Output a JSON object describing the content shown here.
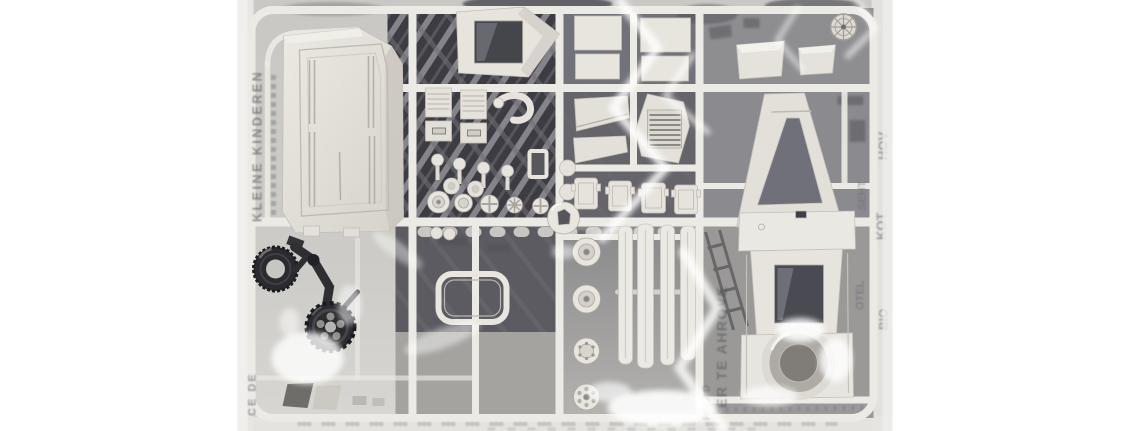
{
  "page": {
    "background_color": "#ffffff"
  },
  "photo": {
    "subject": "Plastic scale-model kit sprue sealed in a clear polybag",
    "description": "Light grey injection-moulded sprue holding a vehicle hull shell, cab, turret housing, road wheels, beams, grilles and hatches; a loose black rubber tyre, crank arm and drive sprocket rest at the lower left; a printed sheet shows through the bag as mirrored ghost lettering.",
    "left_px": 237,
    "top_px": 0,
    "width_px": 656,
    "height_px": 431
  },
  "colors": {
    "margin_white": "#ffffff",
    "bag_grey": "#cbcac6",
    "bag_edge": "#e6e5e2",
    "sprue_plastic": "#e7e5de",
    "part_shading": "#c3c0b8",
    "backing_dark": "#3c3c42",
    "backing_mid": "#77777c",
    "black_parts": "#26262a",
    "highlight_white": "#ffffff"
  },
  "ghost_text": {
    "left_column": "KLEINE KINDEREN",
    "left_bottom": "CE DE",
    "center_column": "ER TE AHROVE",
    "center_column2": "REU D",
    "right_fragments": [
      "HOV",
      "KOT",
      "SEHT",
      "OTEL",
      "BIO"
    ]
  },
  "parts": [
    "hull shell",
    "cab body",
    "roof panels",
    "mudguard panels",
    "louvre grille",
    "cargo grilles",
    "buckle plates",
    "hook pipe",
    "push-rod pins",
    "small wheels",
    "axle boss",
    "hatch covers",
    "frame eyelet",
    "A-frame gantry",
    "equipment boxes",
    "hand wheel",
    "road wheels",
    "side beams",
    "turret housing",
    "turret ring",
    "hatch ring",
    "rubber tyre",
    "crank arm",
    "drive sprocket",
    "ramp wedges"
  ]
}
